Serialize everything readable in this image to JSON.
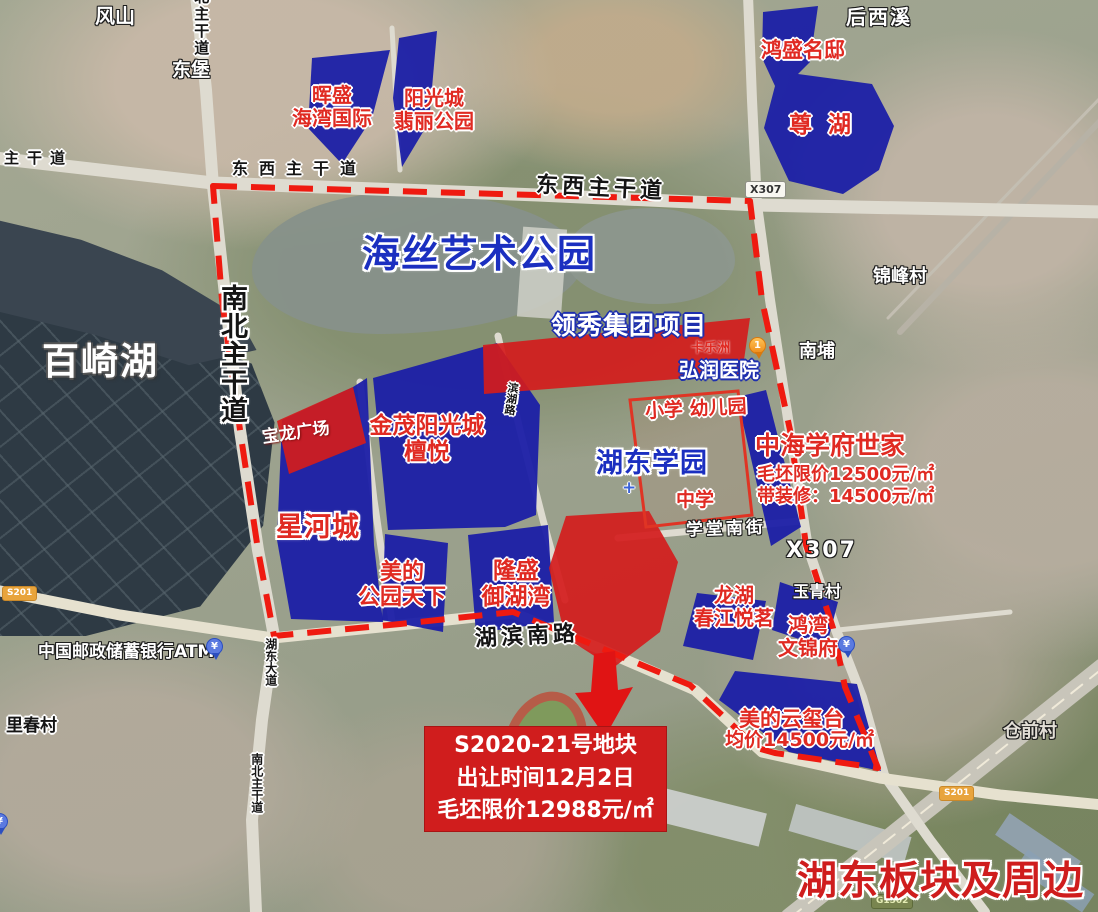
{
  "map_title": "湖东板块及周边",
  "colors": {
    "plot_blue": "#1b1fa6",
    "plot_red": "#d41c1c",
    "boundary_red": "#ef1a10",
    "label_red": "#e02a22",
    "label_blue": "#1b2fc0"
  },
  "landmarks": {
    "haisi_park": "海丝艺术公园",
    "baiqi_lake": "百崎湖",
    "hudong_campus": "湖东学园",
    "primary_kindergarten": "小学 幼儿园",
    "middle_school": "中学",
    "hongrun_hospital": "弘润医院",
    "kalezhou": "卡乐洲",
    "post_atm": "中国邮政储蓄银行ATM"
  },
  "villages": {
    "fengshan": "风山",
    "dongbao": "东堡",
    "houxixi": "后西溪",
    "jinfeng": "锦峰村",
    "nanpu": "南埔",
    "yuqing": "玉青村",
    "cangqian": "仓前村",
    "lichun": "里春村"
  },
  "roads": {
    "dongxi": "东西主干道",
    "nanbei": "南北主干道",
    "hubin_south": "湖滨南路",
    "xuetang_south": "学堂南街",
    "x307": "X307",
    "binhu": "滨湖路",
    "hudong_avenue": "湖东大道",
    "s201": "S201",
    "g1502": "G1502"
  },
  "plots": {
    "huisheng": {
      "line1": "晖盛",
      "line2": "海湾国际"
    },
    "yangguang": {
      "line1": "阳光城",
      "line2": "翡丽公园"
    },
    "hongsheng_mingdi": "鸿盛名邸",
    "zunhu": "尊湖",
    "lingxiu": "领秀集团项目",
    "baolong": "宝龙广场",
    "jinmao": {
      "line1": "金茂阳光城",
      "line2": "檀悦"
    },
    "xinghe": "星河城",
    "meidi_park": {
      "line1": "美的",
      "line2": "公园天下"
    },
    "longsheng": {
      "line1": "隆盛",
      "line2": "御湖湾"
    },
    "zhonghai": {
      "name": "中海学府世家",
      "price1": "毛坯限价12500元/㎡",
      "price2": "带装修：14500元/㎡"
    },
    "longhu": {
      "line1": "龙湖",
      "line2": "春江悦茗"
    },
    "hongwan": {
      "line1": "鸿湾",
      "line2": "文锦府"
    },
    "meidi_yunxitai": {
      "name": "美的云玺台",
      "price": "均价14500元/㎡"
    }
  },
  "infobox": {
    "line1": "S2020-21号地块",
    "line2": "出让时间12月2日",
    "line3": "毛坯限价12988元/㎡"
  },
  "markers": {
    "hospital_pin_number": "1",
    "yuan_symbol": "¥"
  }
}
